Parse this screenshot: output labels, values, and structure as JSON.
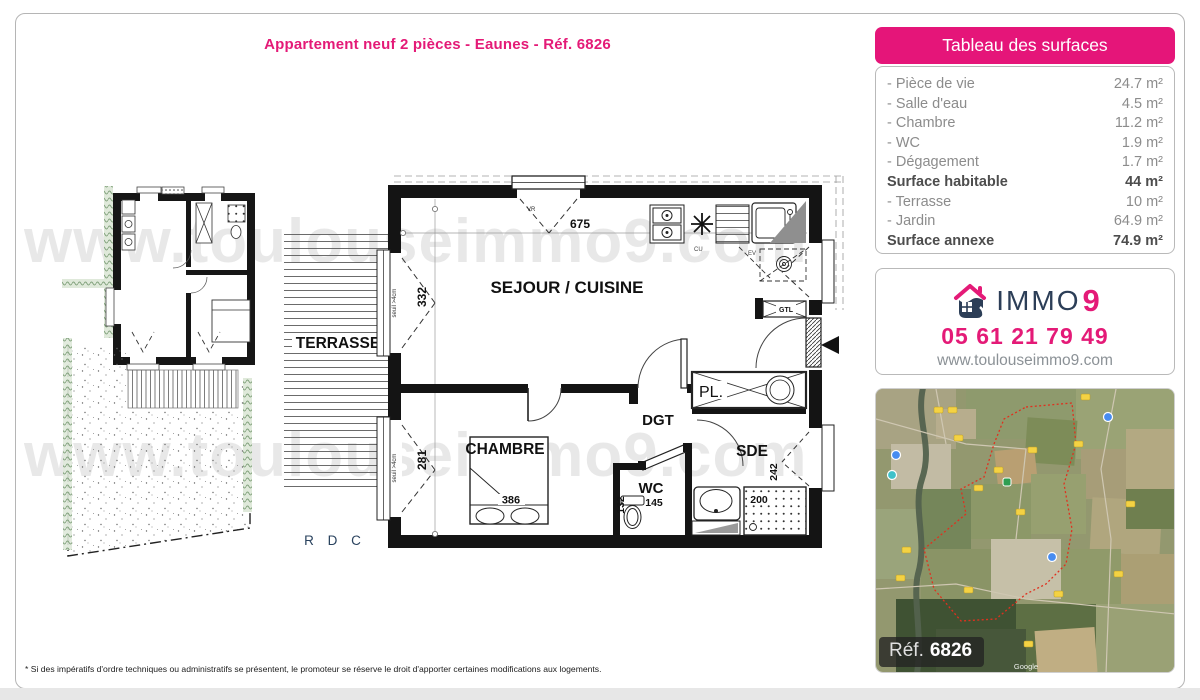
{
  "page": {
    "title": "Appartement neuf 2 pièces - Eaunes - Réf. 6826",
    "footnote": "* Si des impératifs d'ordre techniques ou administratifs se présentent, le promoteur se réserve le droit d'apporter certaines modifications aux logements.",
    "watermark": "www.toulouseimmo9.com"
  },
  "surfaces": {
    "header": "Tableau des surfaces",
    "rows": [
      {
        "label": "- Pièce de vie",
        "value": "24.7 m²"
      },
      {
        "label": "- Salle d'eau",
        "value": "4.5 m²"
      },
      {
        "label": "- Chambre",
        "value": "11.2 m²"
      },
      {
        "label": "- WC",
        "value": "1.9 m²"
      },
      {
        "label": "- Dégagement",
        "value": "1.7 m²"
      },
      {
        "label": "Surface habitable",
        "value": "44 m²"
      },
      {
        "label": "- Terrasse",
        "value": "10 m²"
      },
      {
        "label": "- Jardin",
        "value": "64.9 m²"
      },
      {
        "label": "Surface annexe",
        "value": "74.9 m²"
      }
    ]
  },
  "contact": {
    "brand_immo": "IMMO",
    "brand_nine": "9",
    "phone": "05 61 21 79 49",
    "website": "www.toulouseimmo9.com"
  },
  "map": {
    "ref_label": "Réf.",
    "ref_number": "6826",
    "attribution": "Google"
  },
  "plan": {
    "floor": "R D C",
    "rooms": {
      "sejour": "SEJOUR / CUISINE",
      "terrasse": "TERRASSE",
      "chambre": "CHAMBRE",
      "dgt": "DGT",
      "wc": "WC",
      "sde": "SDE",
      "placard": "PL."
    },
    "dims": {
      "top": "675",
      "window_sejour": "332",
      "window_chambre": "281",
      "bed": "386",
      "wc_width": "132",
      "wc_depth": "145",
      "sde_height": "242",
      "shower": "200"
    },
    "notes": {
      "seuil_sejour": "seuil >4cm",
      "seuil_chambre": "seuil >4cm",
      "vr": "VR",
      "cu": "CU",
      "ev": "EV",
      "gtl": "GTL"
    }
  },
  "colors": {
    "accent_pink": "#e41a77",
    "brand_navy": "#2c3e57"
  }
}
